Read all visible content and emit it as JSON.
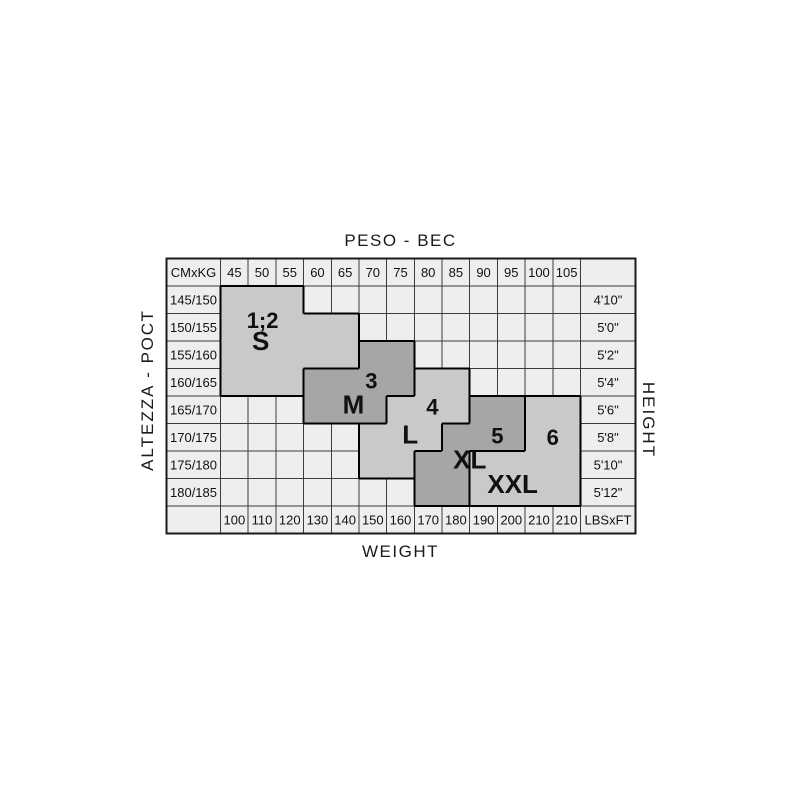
{
  "corners": {
    "top_left": "CMxKG",
    "bottom_right": "LBSxFT"
  },
  "colors": {
    "page_bg": "#ffffff",
    "cell_bg": "#eeeeee",
    "grid_line": "#3c3c3c",
    "table_border": "#1a1a1a",
    "region_light": "#c9c9c9",
    "region_dark": "#a6a6a6",
    "region_outline": "#000000",
    "text": "#111111"
  },
  "chart_data": {
    "type": "table",
    "title": "Size chart: weight (kg/lbs) vs height (cm/ft) with size regions",
    "x_axis": {
      "label_top": "PESO - ВЕС",
      "label_bottom": "WEIGHT",
      "kg": [
        "45",
        "50",
        "55",
        "60",
        "65",
        "70",
        "75",
        "80",
        "85",
        "90",
        "95",
        "100",
        "105"
      ],
      "lbs": [
        "100",
        "110",
        "120",
        "130",
        "140",
        "150",
        "160",
        "170",
        "180",
        "190",
        "200",
        "210",
        "210"
      ]
    },
    "y_axis": {
      "label_left": "ALTEZZA - РОСТ",
      "label_right": "HEIGHT",
      "cm": [
        "145/150",
        "150/155",
        "155/160",
        "160/165",
        "165/170",
        "170/175",
        "175/180",
        "180/185"
      ],
      "ft": [
        "4'10\"",
        "5'0\"",
        "5'2\"",
        "5'4\"",
        "5'6\"",
        "5'8\"",
        "5'10\"",
        "5'12\""
      ]
    },
    "regions": [
      {
        "id": "S",
        "shade": "light",
        "labels": [
          {
            "text": "1;2",
            "variant": "number",
            "col": 2.52,
            "row": 2.25
          },
          {
            "text": "S",
            "variant": "code",
            "col": 2.45,
            "row": 3.0
          }
        ],
        "spans": [
          {
            "row": 1,
            "c1": 1,
            "c2": 3
          },
          {
            "row": 2,
            "c1": 1,
            "c2": 5
          },
          {
            "row": 3,
            "c1": 1,
            "c2": 5
          },
          {
            "row": 4,
            "c1": 1,
            "c2": 3
          }
        ]
      },
      {
        "id": "M",
        "shade": "dark",
        "labels": [
          {
            "text": "3",
            "variant": "number",
            "col": 6.45,
            "row": 4.45
          },
          {
            "text": "M",
            "variant": "code",
            "col": 5.8,
            "row": 5.3
          }
        ],
        "spans": [
          {
            "row": 3,
            "c1": 6,
            "c2": 7
          },
          {
            "row": 4,
            "c1": 4,
            "c2": 7
          },
          {
            "row": 5,
            "c1": 4,
            "c2": 6
          }
        ]
      },
      {
        "id": "L",
        "shade": "light",
        "labels": [
          {
            "text": "4",
            "variant": "number",
            "col": 8.65,
            "row": 5.4
          },
          {
            "text": "L",
            "variant": "code",
            "col": 7.85,
            "row": 6.4
          }
        ],
        "spans": [
          {
            "row": 4,
            "c1": 8,
            "c2": 9
          },
          {
            "row": 5,
            "c1": 7,
            "c2": 9
          },
          {
            "row": 6,
            "c1": 6,
            "c2": 8
          },
          {
            "row": 7,
            "c1": 6,
            "c2": 7
          }
        ]
      },
      {
        "id": "XL",
        "shade": "dark",
        "labels": [
          {
            "text": "5",
            "variant": "number",
            "col": 11.0,
            "row": 6.45
          },
          {
            "text": "XL",
            "variant": "code",
            "col": 10.0,
            "row": 7.3
          }
        ],
        "spans": [
          {
            "row": 5,
            "c1": 10,
            "c2": 11
          },
          {
            "row": 6,
            "c1": 9,
            "c2": 11
          },
          {
            "row": 7,
            "c1": 8,
            "c2": 9
          },
          {
            "row": 8,
            "c1": 8,
            "c2": 9
          }
        ]
      },
      {
        "id": "XXL",
        "shade": "light",
        "labels": [
          {
            "text": "6",
            "variant": "number",
            "col": 13.0,
            "row": 6.5
          },
          {
            "text": "XXL",
            "variant": "code",
            "col": 11.55,
            "row": 8.2
          }
        ],
        "spans": [
          {
            "row": 5,
            "c1": 12,
            "c2": 13
          },
          {
            "row": 6,
            "c1": 12,
            "c2": 13
          },
          {
            "row": 7,
            "c1": 10,
            "c2": 13
          },
          {
            "row": 8,
            "c1": 10,
            "c2": 13
          }
        ]
      }
    ]
  }
}
